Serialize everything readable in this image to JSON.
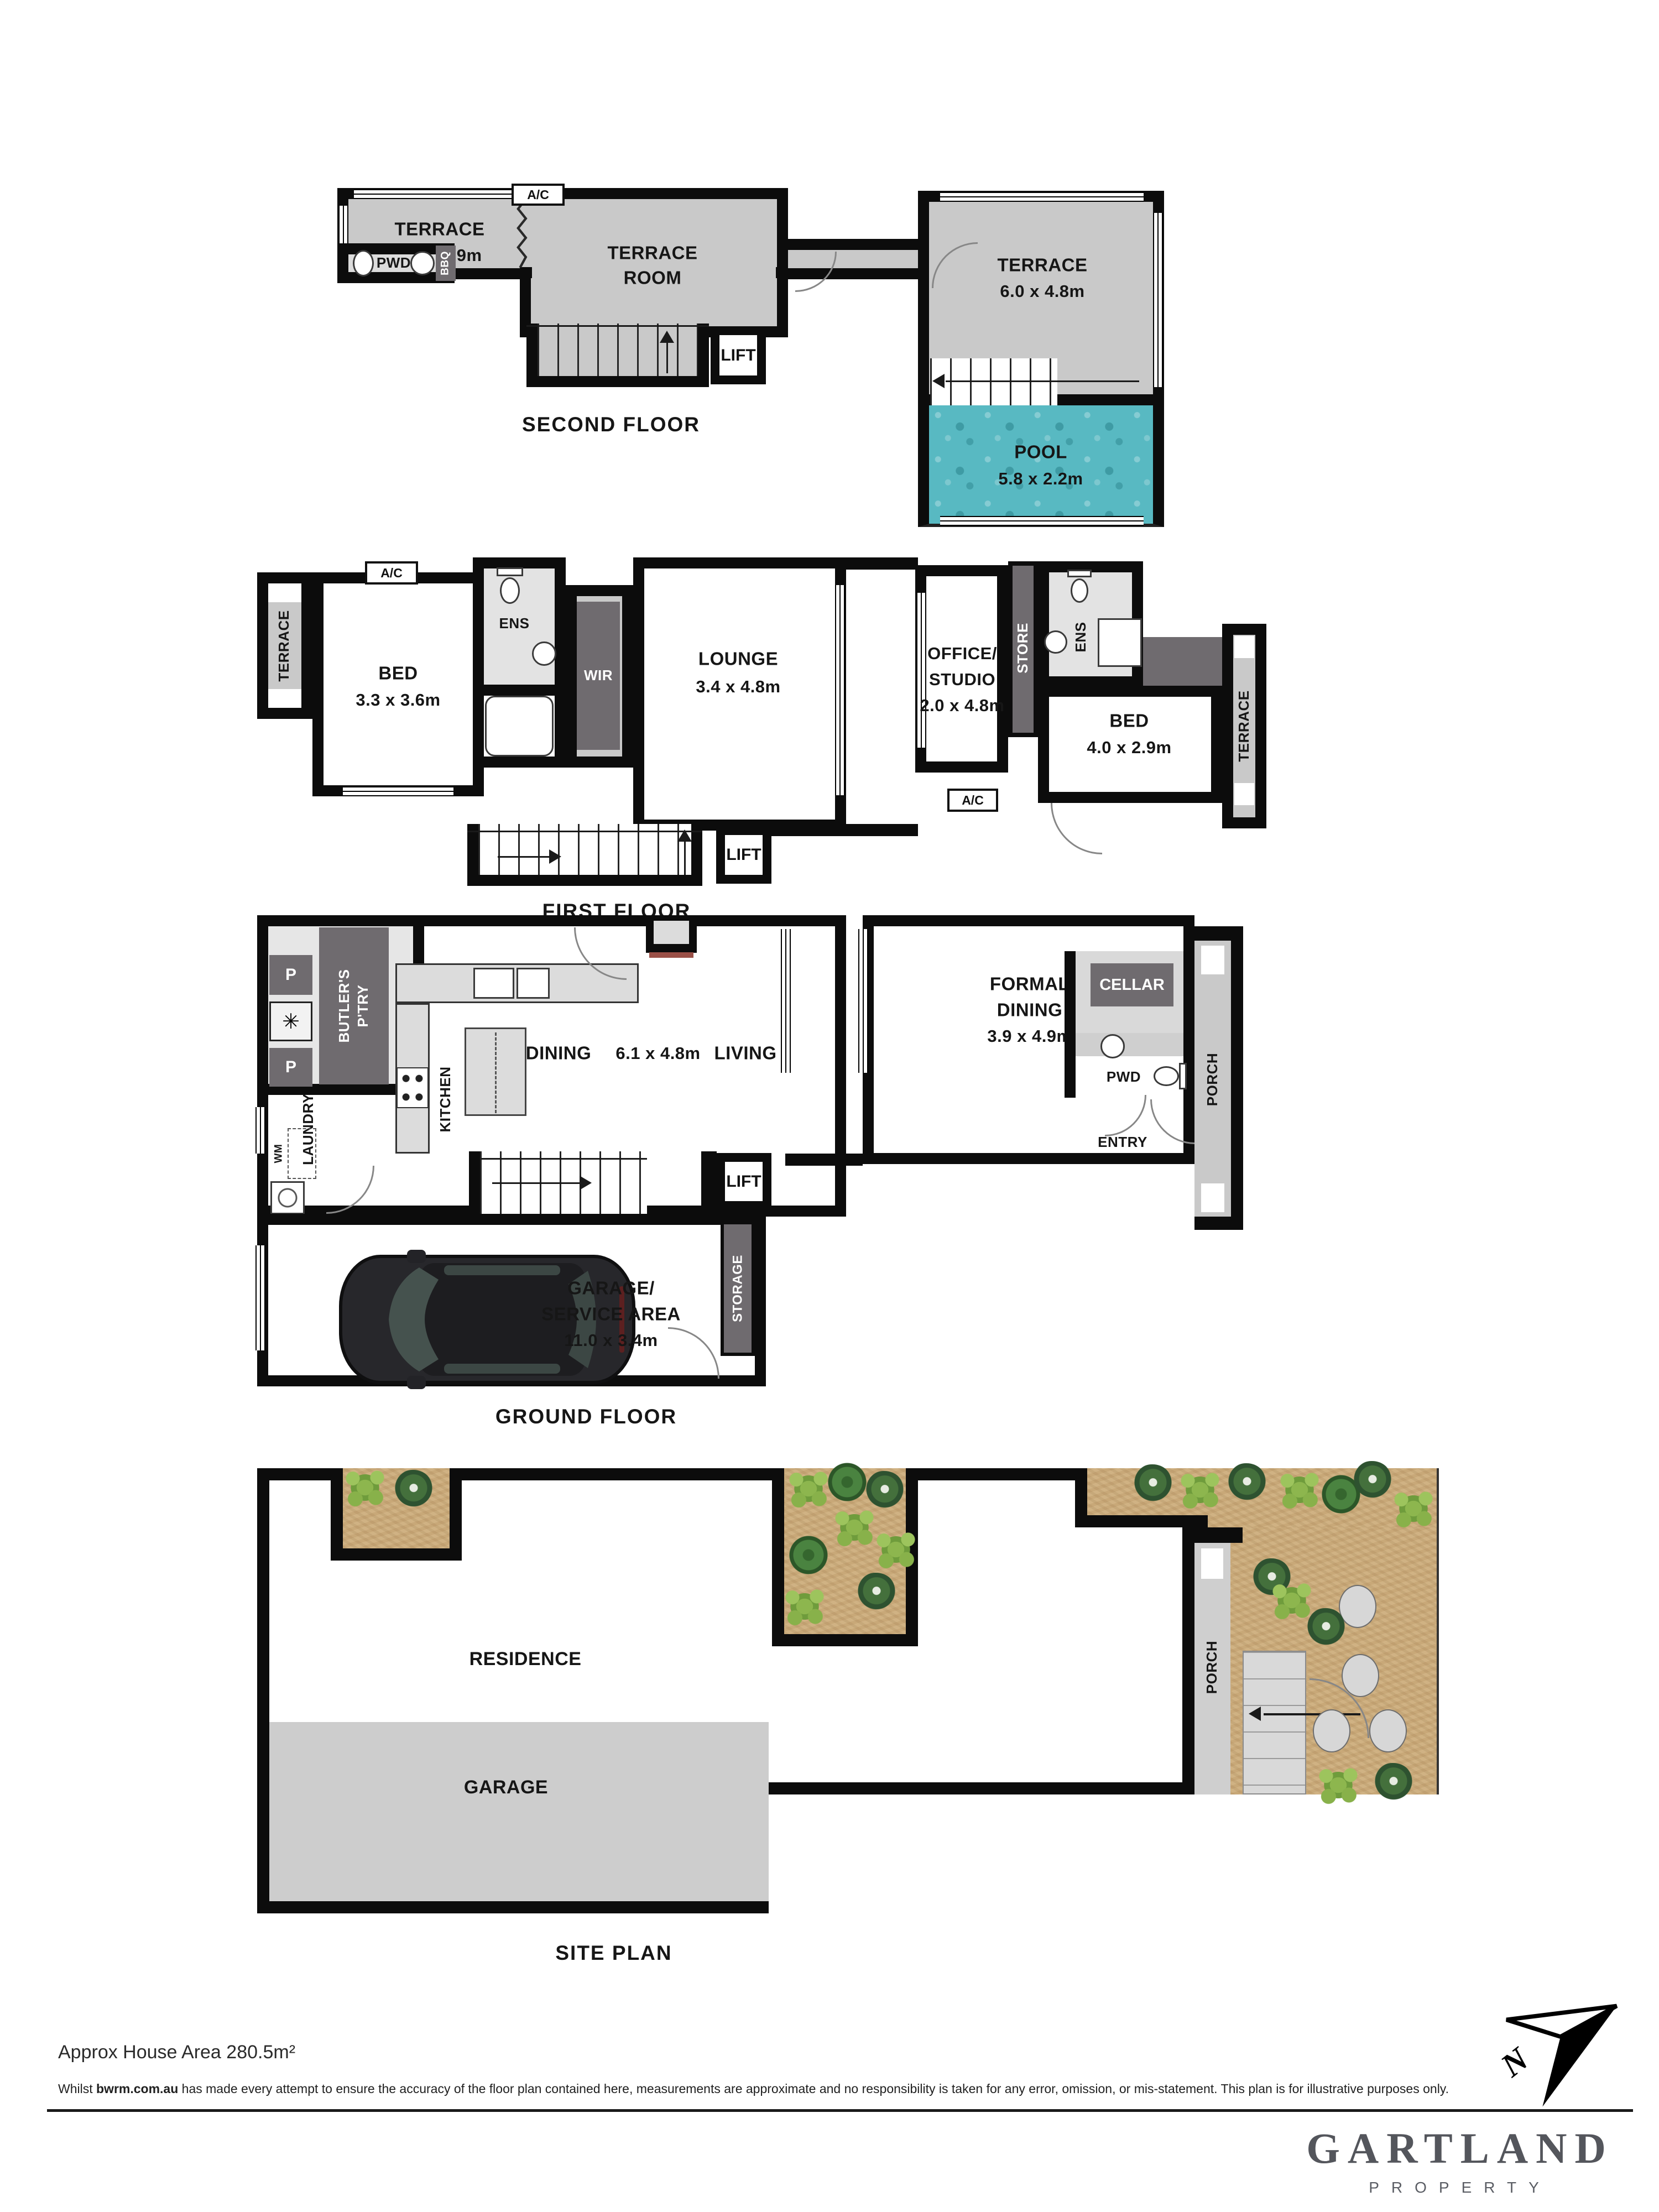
{
  "sf": {
    "caption": "SECOND FLOOR",
    "terrace1": "TERRACE",
    "terrace1_dims": "4.4 x 2.9m",
    "room1": "TERRACE",
    "room2": "ROOM",
    "pwd": "PWD",
    "bbq": "BBQ",
    "ac": "A/C",
    "lift": "LIFT",
    "terrace2": "TERRACE",
    "terrace2_dims": "6.0 x 4.8m",
    "pool": "POOL",
    "pool_dims": "5.8 x 2.2m"
  },
  "ff": {
    "caption": "FIRST FLOOR",
    "terrace_left": "TERRACE",
    "ac1": "A/C",
    "bed1": "BED",
    "bed1_dims": "3.3 x 3.6m",
    "ens1": "ENS",
    "wir": "WIR",
    "ac2": "A/C",
    "lounge": "LOUNGE",
    "lounge_dims": "3.4 x 4.8m",
    "lift": "LIFT",
    "office1": "OFFICE/",
    "office2": "STUDIO",
    "office_dims": "2.0 x 4.8m",
    "store": "STORE",
    "ens2": "ENS",
    "ac3": "A/C",
    "ac4": "A/C",
    "bed2": "BED",
    "bed2_dims": "4.0 x 2.9m",
    "terrace_right": "TERRACE"
  },
  "gf": {
    "caption": "GROUND FLOOR",
    "p1": "P",
    "star": "✳",
    "p2": "P",
    "butlers1": "BUTLER'S",
    "butlers2": "P'TRY",
    "wm": "WM",
    "laundry": "LAUNDRY",
    "kitchen": "KITCHEN",
    "dining": "DINING",
    "dining_dims": "6.1 x 4.8m",
    "living": "LIVING",
    "formal1": "FORMAL",
    "formal2": "DINING",
    "formal_dims": "3.9 x 4.9m",
    "cellar": "CELLAR",
    "pwd": "PWD",
    "porch": "PORCH",
    "entry": "ENTRY",
    "lift": "LIFT",
    "garage1": "GARAGE/",
    "garage2": "SERVICE AREA",
    "garage_dims": "11.0 x 3.4m",
    "storage": "STORAGE"
  },
  "site": {
    "caption": "SITE PLAN",
    "residence": "RESIDENCE",
    "garage": "GARAGE",
    "porch": "PORCH"
  },
  "footer": {
    "area": "Approx House Area 280.5m²",
    "disc1": "Whilst ",
    "disc_bold": "bwrm.com.au",
    "disc2": " has made every attempt to ensure the accuracy of the floor plan contained here, measurements are approximate and no responsibility is taken for any error, omission, or mis-statement. This plan is for illustrative purposes only.",
    "north": "N"
  },
  "logo": {
    "name": "GARTLAND",
    "tagline": "PROPERTY"
  },
  "colors": {
    "wall": "#0c0c0c",
    "terrace": "#c9c9c9",
    "dark": "#6f6b6f",
    "pool": "#58b9c2",
    "garden": "#c8a878",
    "site_garage": "#cdcdcd"
  }
}
